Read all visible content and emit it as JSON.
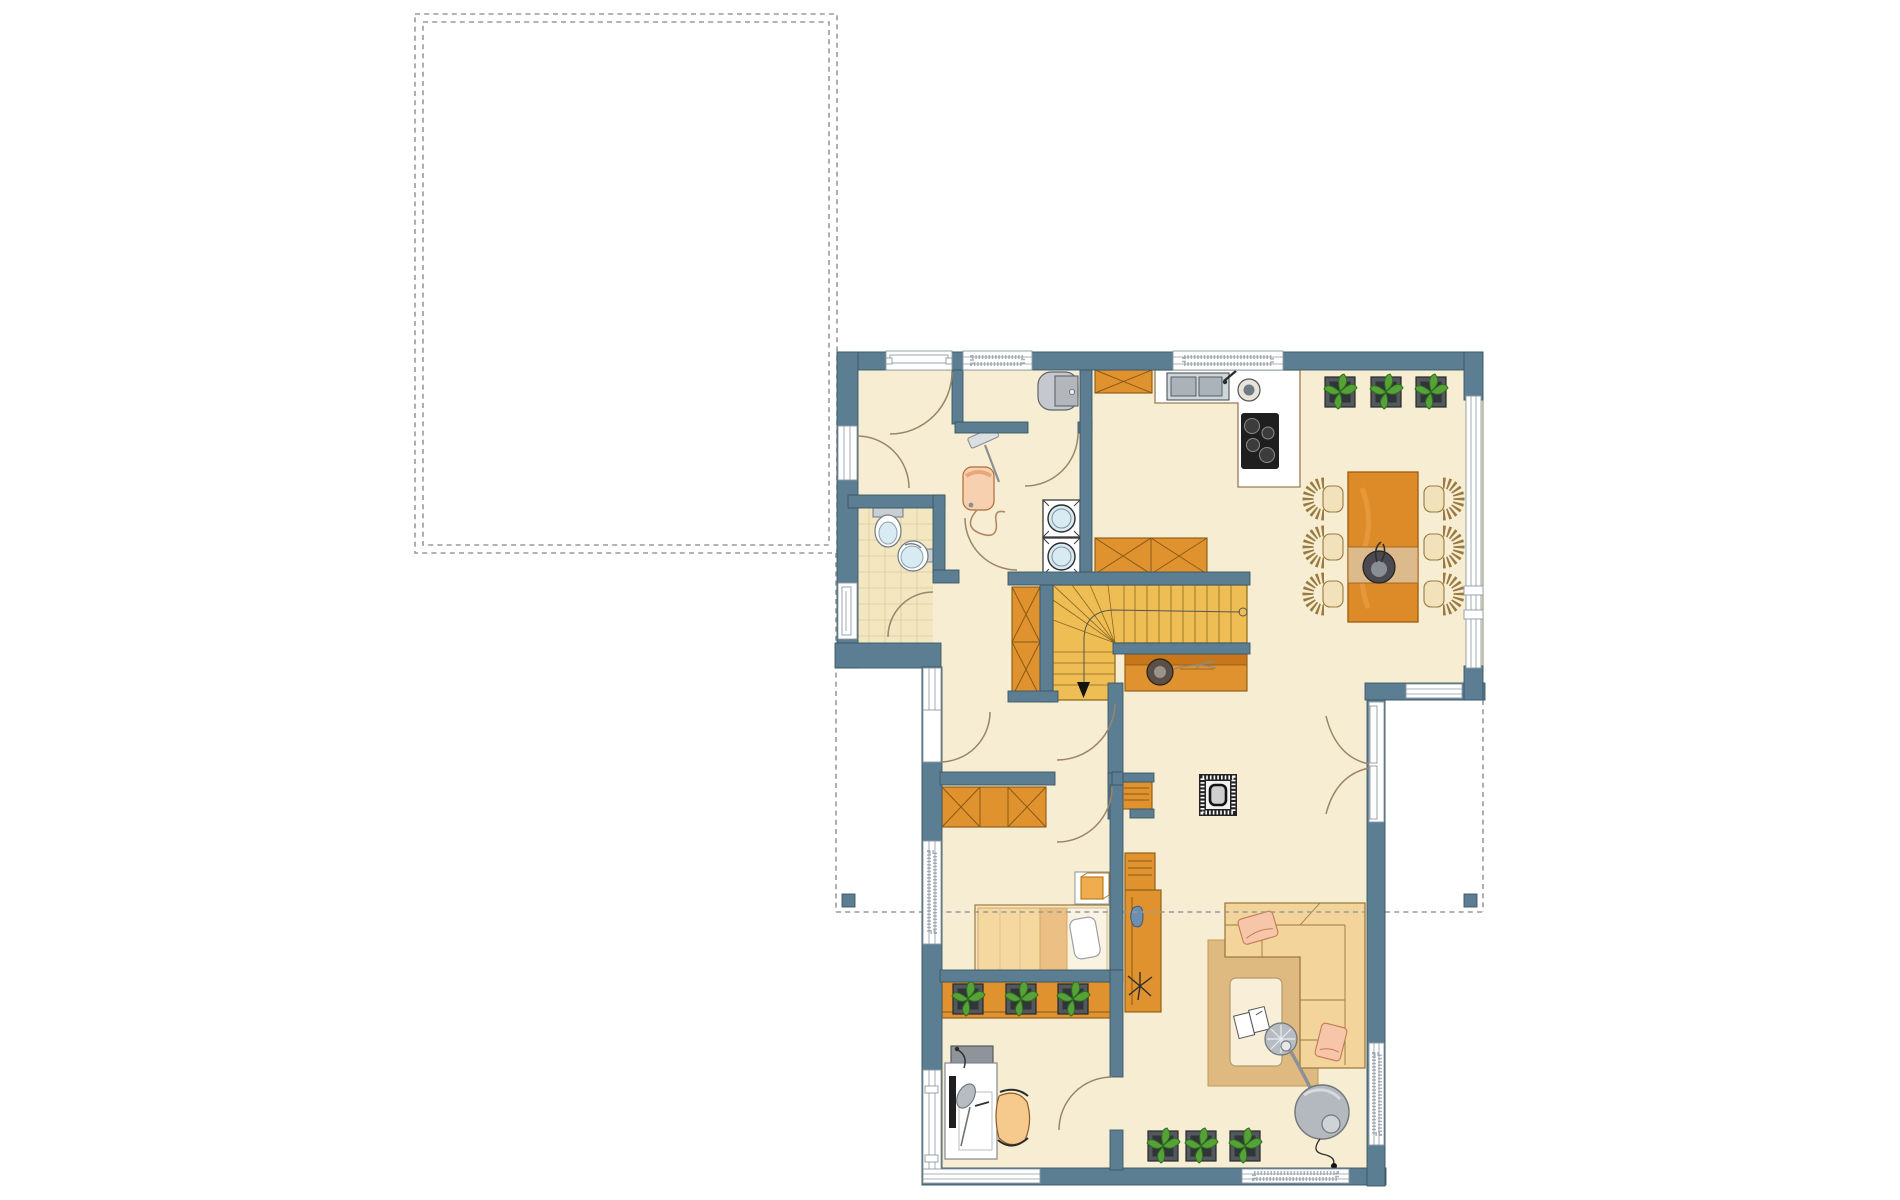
{
  "canvas": {
    "width": 1900,
    "height": 1200,
    "background": "#ffffff"
  },
  "palette": {
    "wall": "#5b7e92",
    "wallStroke": "#3b5866",
    "floor": "#f6edd2",
    "floorEdge": "#8a8a7a",
    "tile": "#f3e7c2",
    "tileLine": "#ddcb97",
    "winStroke": "#8e9aa2",
    "dashGrey": "#9a9a9a",
    "arcBrown": "#9b8468",
    "orange": "#e0922f",
    "orangeDark": "#c9761b",
    "orangeStroke": "#8a5a14",
    "stairs": "#eebe55",
    "stairsStroke": "#8a6820",
    "woodLight": "#f4d8a0",
    "woodMid": "#ecc084",
    "woodStroke": "#9a7a40",
    "chairSeat": "#f2e2bc",
    "tableOrange": "#dd8b28",
    "runner": "#dcba8c",
    "rug": "#dfba80",
    "rugStroke": "#c09a58",
    "pillow": "#f7c6a8",
    "pillowStroke": "#c4795a",
    "plantGreen": "#57a238",
    "plantDark": "#2f6d1f",
    "potFill": "#53585c",
    "potInner": "#303539",
    "applianceGlass": "#d8ebf3",
    "fixStroke": "#6f7a84",
    "lampGrey": "#b6bcc1",
    "lampDark": "#70767c",
    "boilerGrey": "#c5c8cc",
    "hobBlack": "#1f1f1f",
    "black": "#141414"
  },
  "plan": {
    "type": "floor-plan",
    "text_labels": [],
    "dashed_outline": "lower-floor-footprint-and-garage",
    "rooms": [
      {
        "name": "entrance-hall"
      },
      {
        "name": "wc"
      },
      {
        "name": "utility-niche"
      },
      {
        "name": "kitchen"
      },
      {
        "name": "dining-area"
      },
      {
        "name": "stair-hall"
      },
      {
        "name": "corridor"
      },
      {
        "name": "bedroom"
      },
      {
        "name": "office"
      },
      {
        "name": "living-area"
      }
    ],
    "furniture": [
      "entrance-door",
      "vacuum-cleaner",
      "boiler",
      "washer-dryer-stack",
      "toilet",
      "wash-basin",
      "kitchen-counter",
      "kitchen-sink",
      "cooktop",
      "kitchen-island",
      "wall-cabinet",
      "dining-table",
      "dining-chairs-x6",
      "potted-plants-x9",
      "winder-staircase",
      "stair-arrow",
      "hall-wardrobe",
      "sideboard-with-bowl",
      "wood-stove",
      "book-shelf",
      "double-bed",
      "nightstand",
      "bedroom-wardrobe",
      "plant-sideboard",
      "desk",
      "office-chair",
      "corner-sofa",
      "coffee-table",
      "arc-floor-lamp",
      "rug",
      "french-doors",
      "terrace-posts"
    ]
  }
}
